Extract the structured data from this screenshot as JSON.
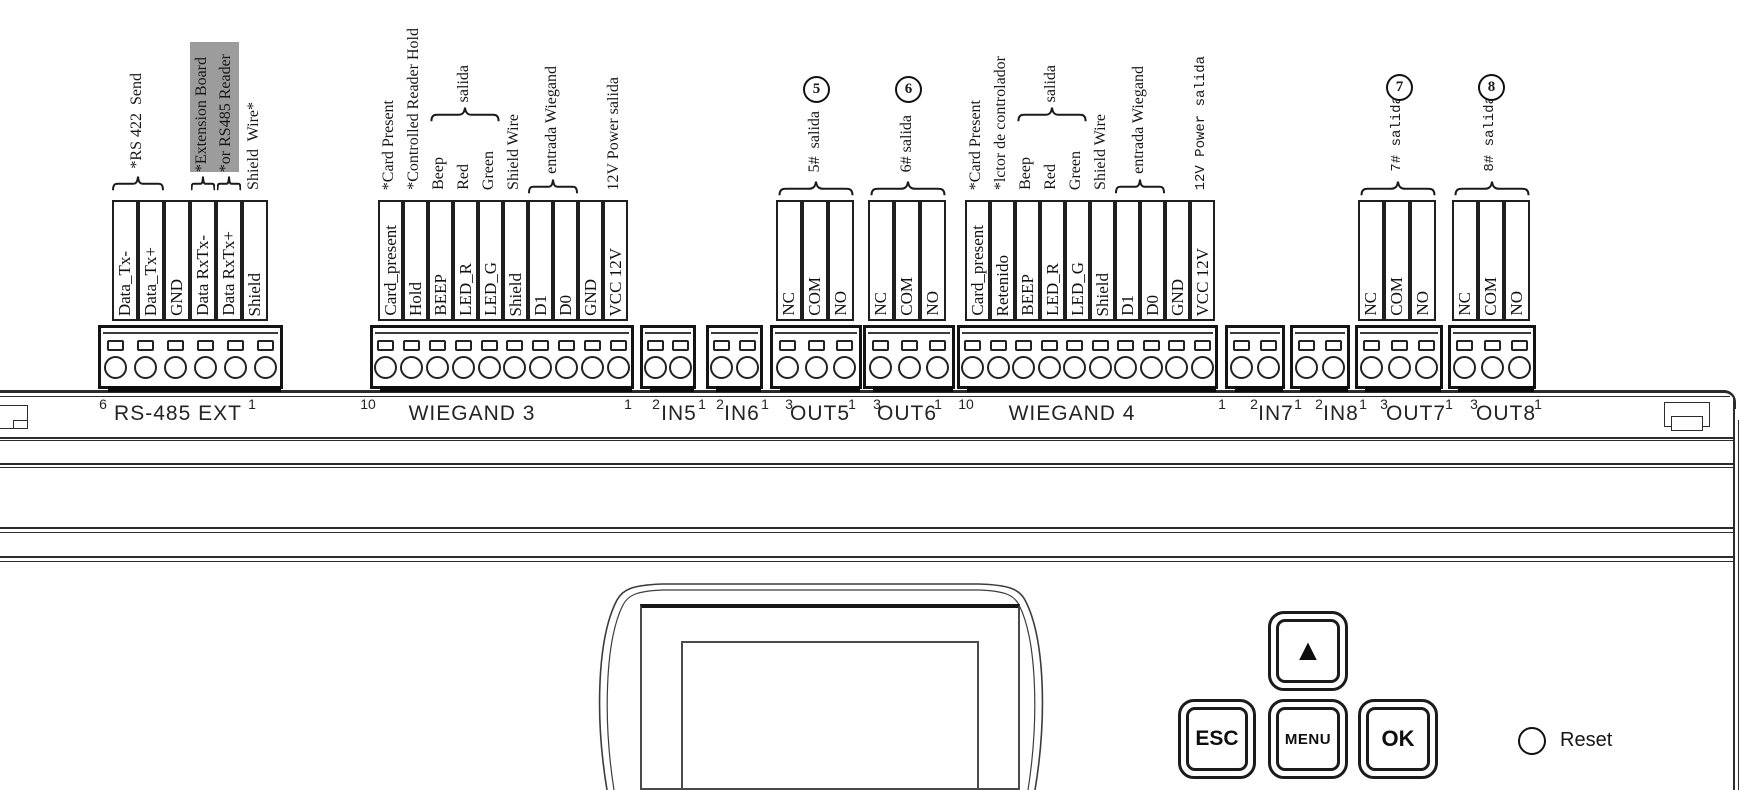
{
  "blocks": [
    {
      "name": "RS-485 EXT",
      "pin_start": "6",
      "pin_end": "1",
      "terminals": [
        "Data_Tx-",
        "Data_Tx+",
        "GND",
        "Data RxTx-",
        "Data RxTx+",
        "Shield"
      ],
      "annotations": {
        "rs422": "*RS 422  Send",
        "ext_line1": "*Extension Board",
        "ext_line2": "*or RS485 Reader",
        "shield": "Shield  Wire*"
      }
    },
    {
      "name": "WIEGAND 3",
      "pin_start": "10",
      "pin_end": "1",
      "terminals": [
        "Card_present",
        "Hold",
        "BEEP",
        "LED_R",
        "LED_G",
        "Shield",
        "D1",
        "D0",
        "GND",
        "VCC 12V"
      ],
      "annotations": {
        "card": "*Card Present",
        "hold": "*Controlled Reader Hold",
        "beep": "Beep",
        "red": "Red",
        "green": "Green",
        "salida": "salida",
        "shield": "Shield Wire",
        "entrada": "entrada Wiegand",
        "power": "12V Power salida"
      }
    },
    {
      "name": "IN5",
      "pin_start": "2",
      "pin_end": "1"
    },
    {
      "name": "IN6",
      "pin_start": "2",
      "pin_end": "1"
    },
    {
      "name": "OUT5",
      "pin_start": "3",
      "pin_end": "1",
      "terminals": [
        "NC",
        "COM",
        "NO"
      ],
      "annotations": {
        "salida": "5#  salida",
        "circled_number": "5"
      }
    },
    {
      "name": "OUT6",
      "pin_start": "3",
      "pin_end": "1",
      "terminals": [
        "NC",
        "COM",
        "NO"
      ],
      "annotations": {
        "salida": "6# salida",
        "circled_number": "6"
      }
    },
    {
      "name": "WIEGAND 4",
      "pin_start": "10",
      "pin_end": "1",
      "terminals": [
        "Card_present",
        "Retenido",
        "BEEP",
        "LED_R",
        "LED_G",
        "Shield",
        "D1",
        "D0",
        "GND",
        "VCC 12V"
      ],
      "annotations": {
        "card": "*Card Present",
        "reader": "*lctor de controlador",
        "beep": "Beep",
        "red": "Red",
        "green": "Green",
        "salida": "salida",
        "shield": "Shield Wire",
        "entrada": "entrada Wiegand",
        "power": "12V Power salida"
      }
    },
    {
      "name": "IN7",
      "pin_start": "2",
      "pin_end": "1"
    },
    {
      "name": "IN8",
      "pin_start": "2",
      "pin_end": "1"
    },
    {
      "name": "OUT7",
      "pin_start": "3",
      "pin_end": "1",
      "terminals": [
        "NC",
        "COM",
        "NO"
      ],
      "annotations": {
        "salida": "7# salida",
        "circled_number": "7"
      }
    },
    {
      "name": "OUT8",
      "pin_start": "3",
      "pin_end": "1",
      "terminals": [
        "NC",
        "COM",
        "NO"
      ],
      "annotations": {
        "salida": "8# salida",
        "circled_number": "8"
      }
    }
  ],
  "keypad": {
    "up": "▲",
    "esc": "ESC",
    "menu": "MENU",
    "ok": "OK",
    "reset": "Reset"
  },
  "colors": {
    "ink": "#1a1a1a",
    "highlight": "#9c9c9c"
  }
}
